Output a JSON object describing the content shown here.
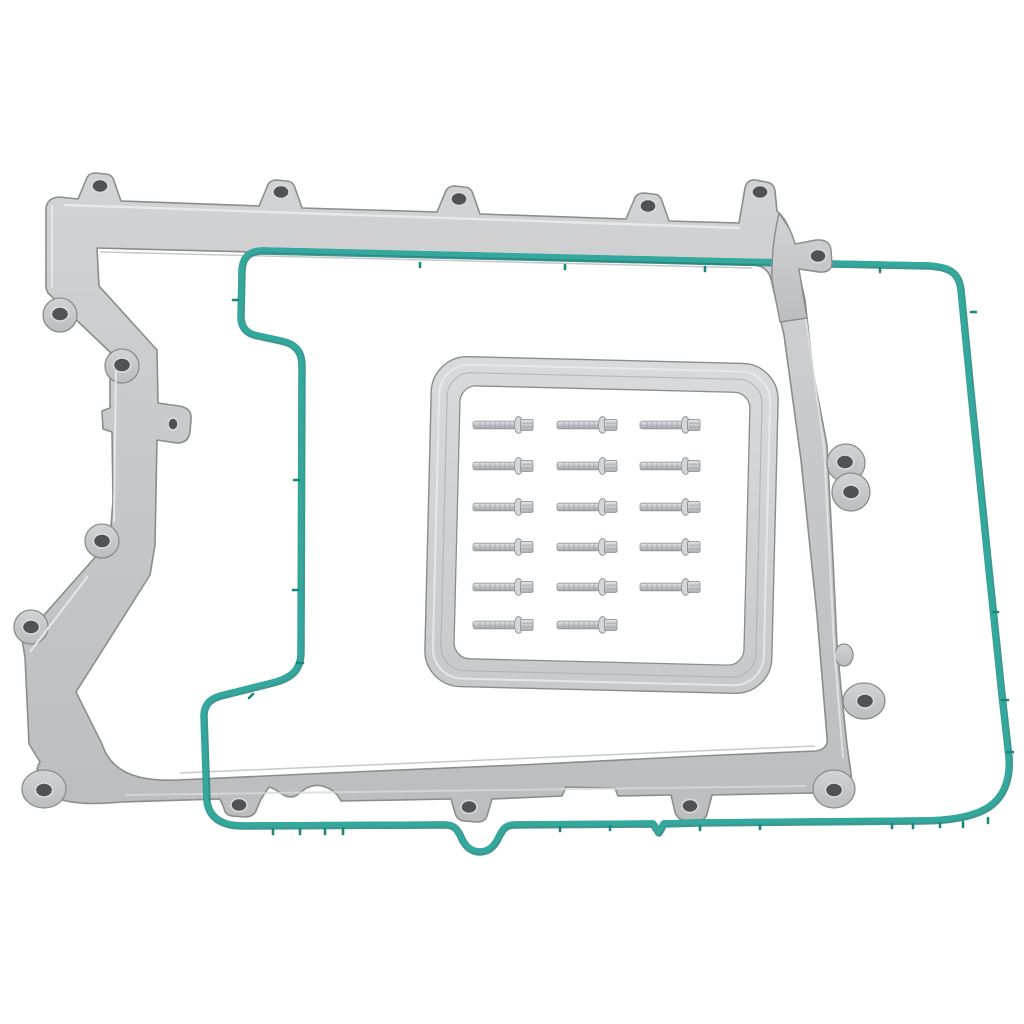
{
  "scene": {
    "caption": "Product photo on white background: large cast-aluminum spacer frame with mounting tabs and holes, a green rubber perimeter gasket seal, a smaller rounded-square aluminum frame, and seventeen hex flange bolts arranged in a grid",
    "background": "#ffffff"
  },
  "colors": {
    "metal": "#c7c8ca",
    "metal_light": "#e8e9eb",
    "metal_dark": "#9c9da0",
    "outline": "#8a8c8e",
    "hole": "#515254",
    "hole_rim": "#dcdde0",
    "gasket": "#33a89c",
    "gasket_dark": "#1b867c",
    "bolt_edge": "#8f9396"
  },
  "parts": {
    "main_frame": {
      "label": "aluminum-spacer-frame",
      "mounting_hole_count": 18,
      "top_tab_count": 5,
      "bottom_tab_count": 3,
      "side_features": "double-hole boss, side tabs, corner ears"
    },
    "gasket": {
      "label": "green-rubber-gasket",
      "shape": "rounded rectangle with stepped left side, bottom dip and small molding nubs"
    },
    "adapter_frame": {
      "label": "inner-aluminum-frame",
      "shape": "rounded square ring"
    },
    "bolts": {
      "label": "hex-flange-bolts",
      "count": 17,
      "rows": 6,
      "columns": 3,
      "per_row": [
        3,
        3,
        3,
        3,
        3,
        2
      ],
      "col_x": [
        473,
        557,
        640
      ],
      "row_y": [
        425,
        466,
        507,
        547,
        587,
        625
      ]
    }
  }
}
